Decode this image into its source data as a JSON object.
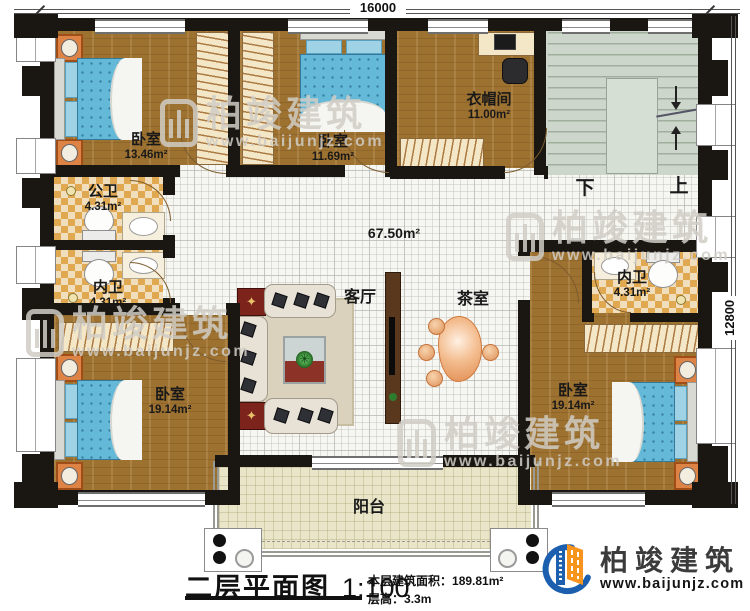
{
  "dimensions": {
    "top": "16000",
    "right": "12800"
  },
  "rooms": {
    "bedroom_top_left": {
      "name": "卧室",
      "area": "13.46m²"
    },
    "bedroom_top_mid": {
      "name": "卧室",
      "area": "11.69m²"
    },
    "cloakroom": {
      "name": "衣帽间",
      "area": "11.00m²"
    },
    "public_bathroom": {
      "name": "公卫",
      "area": "4.31m²"
    },
    "inner_bathroom_left": {
      "name": "内卫",
      "area": "4.31m²"
    },
    "inner_bathroom_right": {
      "name": "内卫",
      "area": "4.31m²"
    },
    "bedroom_bottom_left": {
      "name": "卧室",
      "area": "19.14m²"
    },
    "bedroom_bottom_right": {
      "name": "卧室",
      "area": "19.14m²"
    },
    "living_room": {
      "name": "客厅"
    },
    "tea_room": {
      "name": "茶室"
    },
    "balcony": {
      "name": "阳台"
    },
    "hall": {
      "area": "67.50m²"
    }
  },
  "stairs": {
    "down": "下",
    "up": "上"
  },
  "title": {
    "plan_name": "二层平面图",
    "scale": "1:100",
    "floor_area_label": "本层建筑面积：",
    "floor_area_value": "189.81m²",
    "floor_height_label": "层高：",
    "floor_height_value": "3.3m"
  },
  "branding": {
    "watermark_brand": "柏竣建筑",
    "watermark_url": "www.baijunjz.com",
    "logo_brand": "柏竣建筑",
    "logo_url": "www.baijunjz.com"
  },
  "colors": {
    "wall": "#1a1713",
    "wood_floor": "#9d7130",
    "tile_light": "#f1debc",
    "tile_dark": "#e0a951",
    "hall_floor": "#f6f6f2",
    "stair_floor": "#ccd6ca",
    "balcony_floor": "#e9e5c9",
    "bed_blue": "#64b9d8",
    "nightstand_orange": "#dd8345",
    "accent_red": "#7c241b",
    "logo_blue": "#1b5fae",
    "logo_orange": "#f7941d"
  }
}
